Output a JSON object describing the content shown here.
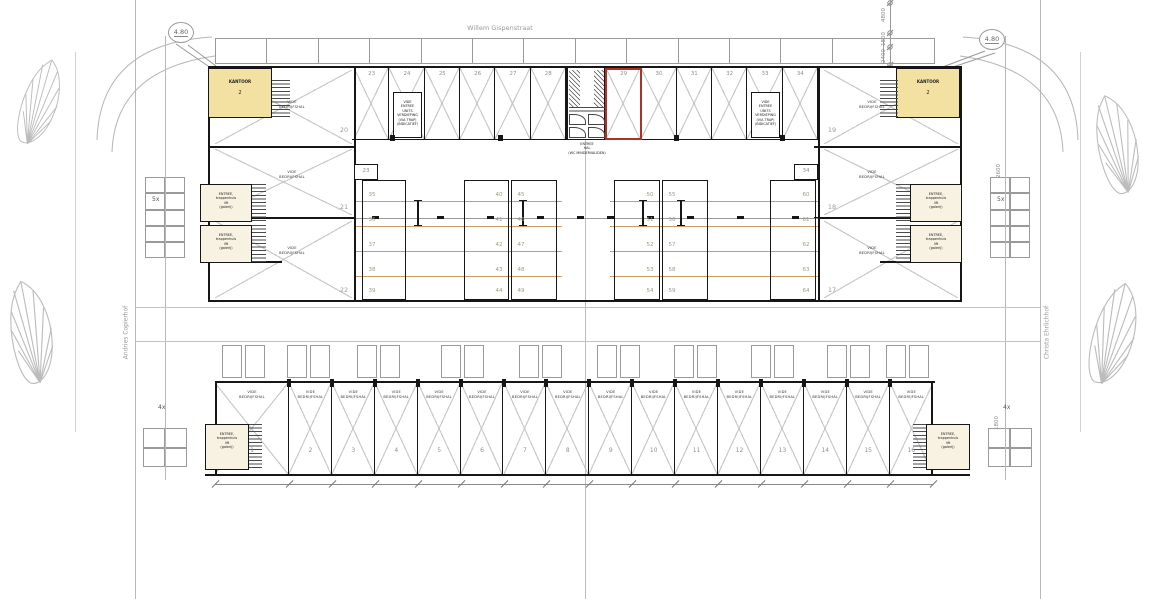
{
  "plan": {
    "streets": {
      "top": "Willem Gispenstraat",
      "left": "Andries Copierhof",
      "right": "Christa Ehrlichhof"
    },
    "spot_height_left": "4.80",
    "spot_height_right": "4.80",
    "dims_top_right": [
      "4800",
      "1800",
      "2400"
    ],
    "dims_right_edge": [
      "2600",
      "1800"
    ],
    "parking_count_side": "5x",
    "parking_count_bottom": "4x",
    "room_labels": {
      "kantoor": {
        "title": "KANTOOR",
        "number": "2"
      },
      "entree_lines": [
        "ENTREE,",
        "trappenhuis",
        "lift",
        "(galerij)"
      ],
      "vide_lines": [
        "VIDE",
        "BEDRIJFSHAL"
      ],
      "core_lines": [
        "ENTREE",
        "HAL",
        "(WC MINDERVALIDEN)"
      ],
      "unit_note_lines": [
        "VIDE",
        "ENTREE",
        "UNITS VERDIEPING",
        "(VIA TRAP)",
        "(INDICATIEF)"
      ]
    },
    "halls_left": [
      "20",
      "21",
      "22"
    ],
    "halls_right": [
      "19",
      "18",
      "17"
    ],
    "top_units_left": [
      "23",
      "24",
      "25",
      "26",
      "27",
      "28"
    ],
    "top_units_right": [
      "29",
      "30",
      "31",
      "32",
      "33",
      "34"
    ],
    "highlighted_unit": "29",
    "corner_unit_left": "23",
    "corner_unit_right": "34",
    "storage_columns": [
      [
        "35",
        "36",
        "37",
        "38",
        "39"
      ],
      [
        "40",
        "41",
        "42",
        "43",
        "44"
      ],
      [
        "45",
        "46",
        "47",
        "48",
        "49"
      ],
      [
        "50",
        "51",
        "52",
        "53",
        "54"
      ],
      [
        "55",
        "56",
        "57",
        "58",
        "59"
      ],
      [
        "60",
        "61",
        "62",
        "63",
        "64"
      ]
    ],
    "bottom_units": [
      "1",
      "2",
      "3",
      "4",
      "5",
      "6",
      "7",
      "8",
      "9",
      "10",
      "11",
      "12",
      "13",
      "14",
      "15",
      "16"
    ],
    "colors": {
      "highlight": "#ad3127",
      "room_yellow": "#f3e1a2",
      "room_cream": "#f7f2e1",
      "shelf_line": "#c99e63"
    }
  }
}
